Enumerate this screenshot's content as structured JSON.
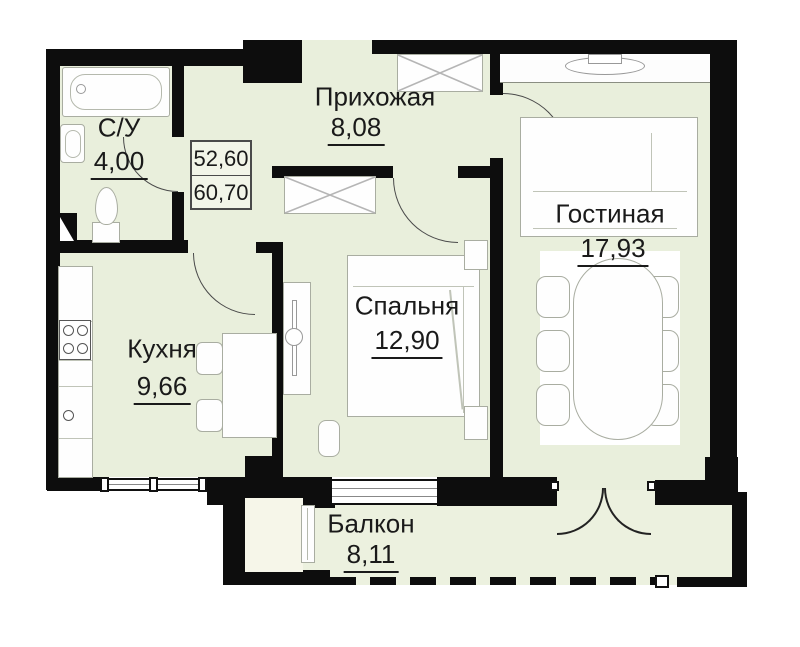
{
  "plan": {
    "area_box": {
      "top": "52,60",
      "bottom": "60,70"
    },
    "rooms": [
      {
        "name": "Прихожая",
        "area": "8,08"
      },
      {
        "name": "С/У",
        "area": "4,00"
      },
      {
        "name": "Кухня",
        "area": "9,66"
      },
      {
        "name": "Спальня",
        "area": "12,90"
      },
      {
        "name": "Гостиная",
        "area": "17,93"
      },
      {
        "name": "Балкон",
        "area": "8,11"
      }
    ],
    "colors": {
      "wall": "#0d0d0d",
      "floor": "#e9efdc",
      "closet_interior": "#f6f6e9",
      "text": "#1a1a1a"
    }
  }
}
